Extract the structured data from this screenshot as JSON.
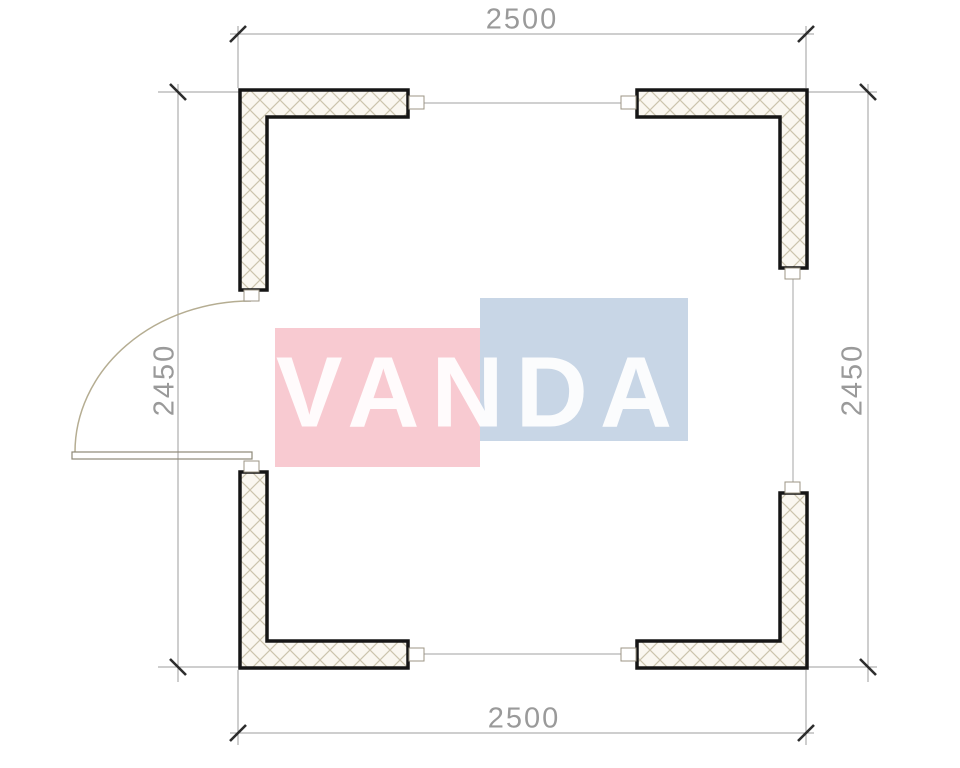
{
  "watermark": {
    "text": "VANDA",
    "pink_color": "#f8cad1",
    "blue_color": "#c8d6e6",
    "text_color": "#ffffff"
  },
  "dimensions": {
    "top": {
      "label": "2500"
    },
    "bottom": {
      "label": "2500"
    },
    "left": {
      "label": "2450"
    },
    "right": {
      "label": "2450"
    }
  },
  "colors": {
    "wall_outline": "#151515",
    "hatch_line": "#ccc4ad",
    "hatch_background": "#faf7f0",
    "dimension_line": "#9c9c9c",
    "tick": "#2d2d2d",
    "door_arc": "#b5ad92",
    "door_leaf": "#8e8877"
  }
}
